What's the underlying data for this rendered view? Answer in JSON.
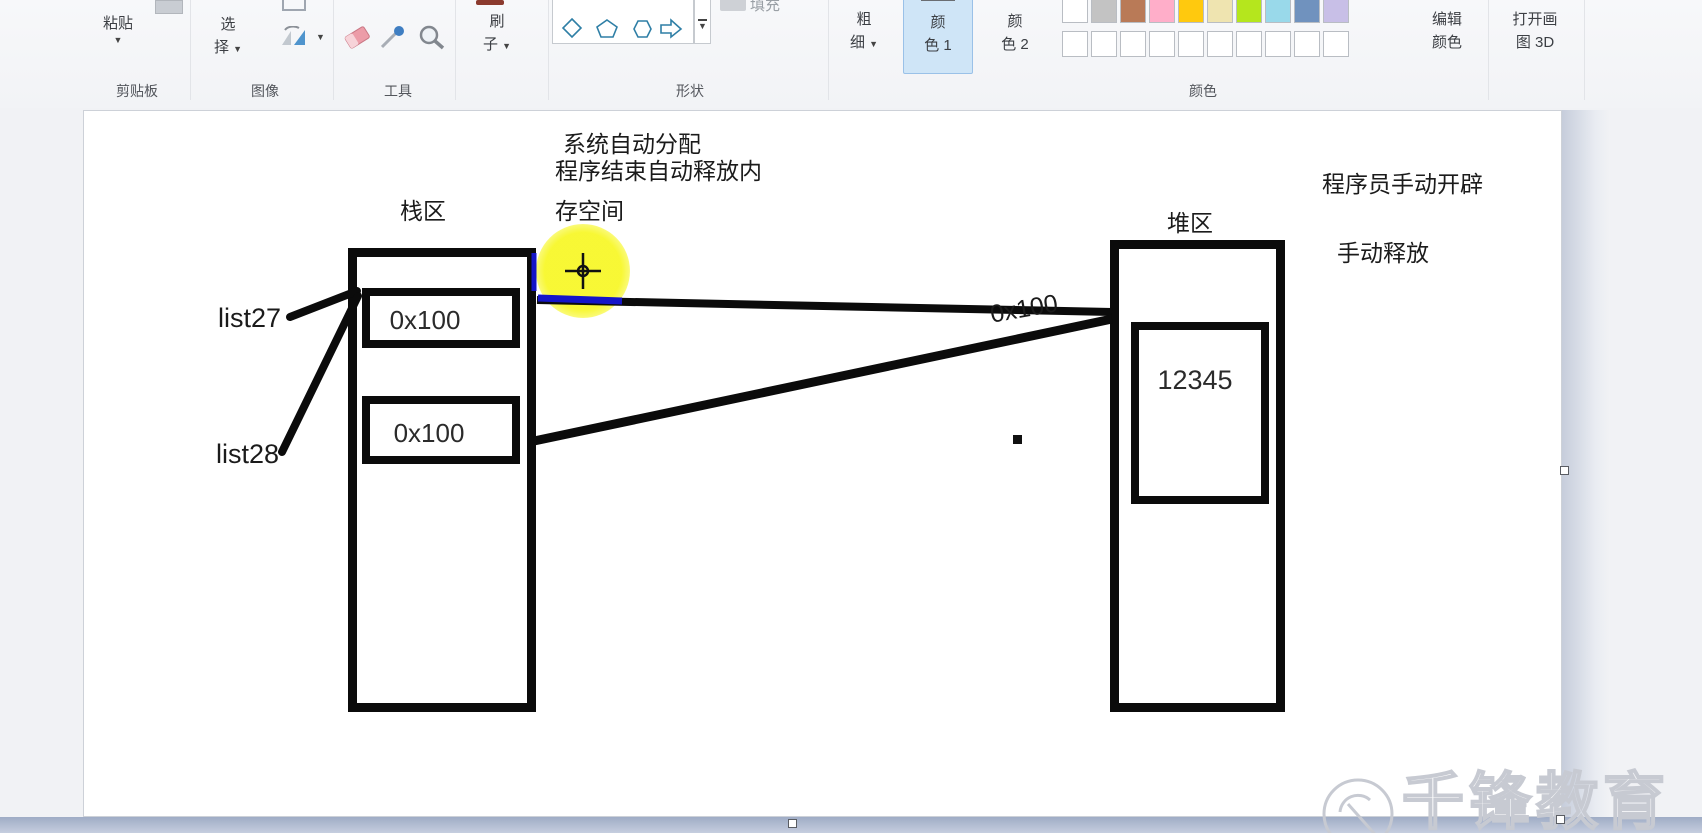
{
  "ribbon": {
    "paste_label": "粘贴",
    "select_line1": "选",
    "select_line2": "择",
    "brush_line1": "刷",
    "brush_line2": "子",
    "size_line1": "粗",
    "size_line2": "细",
    "fill_label": "填充",
    "color1_line1": "颜",
    "color1_line2": "色 1",
    "color2_line1": "颜",
    "color2_line2": "色 2",
    "edit_colors_line1": "编辑",
    "edit_colors_line2": "颜色",
    "paint3d_line1": "打开画",
    "paint3d_line2": "图 3D",
    "group_labels": {
      "clipboard": "剪贴板",
      "image": "图像",
      "tools": "工具",
      "shapes": "形状",
      "colors": "颜色"
    },
    "color1_value": "#000000",
    "color2_value": "#ffffff",
    "accent_selected_bg": "#cfe5f7",
    "palette_row1": [
      "#ffffff",
      "#c3c3c3",
      "#b97a57",
      "#ffaec9",
      "#ffc90e",
      "#efe4b0",
      "#b5e61d",
      "#99d9ea",
      "#7092be",
      "#c8bfe7"
    ],
    "palette_row2": [
      "#ffffff",
      "#ffffff",
      "#ffffff",
      "#ffffff",
      "#ffffff",
      "#ffffff",
      "#ffffff",
      "#ffffff",
      "#ffffff",
      "#ffffff"
    ]
  },
  "canvas": {
    "stack_title": "栈区",
    "heap_title": "堆区",
    "note_top": [
      "系统自动分配",
      "程序结束自动释放内",
      "存空间"
    ],
    "note_right": [
      "程序员手动开辟",
      "手动释放"
    ],
    "var1": "list27",
    "var2": "list28",
    "stack_cell1": "0x100",
    "stack_cell2": "0x100",
    "heap_addr": "0x100",
    "heap_value": "12345",
    "ink_color": "#0b0b0b",
    "highlight_color": "#f7f72a",
    "blue_stroke": "#1515c8",
    "watermark": "千锋教育"
  }
}
